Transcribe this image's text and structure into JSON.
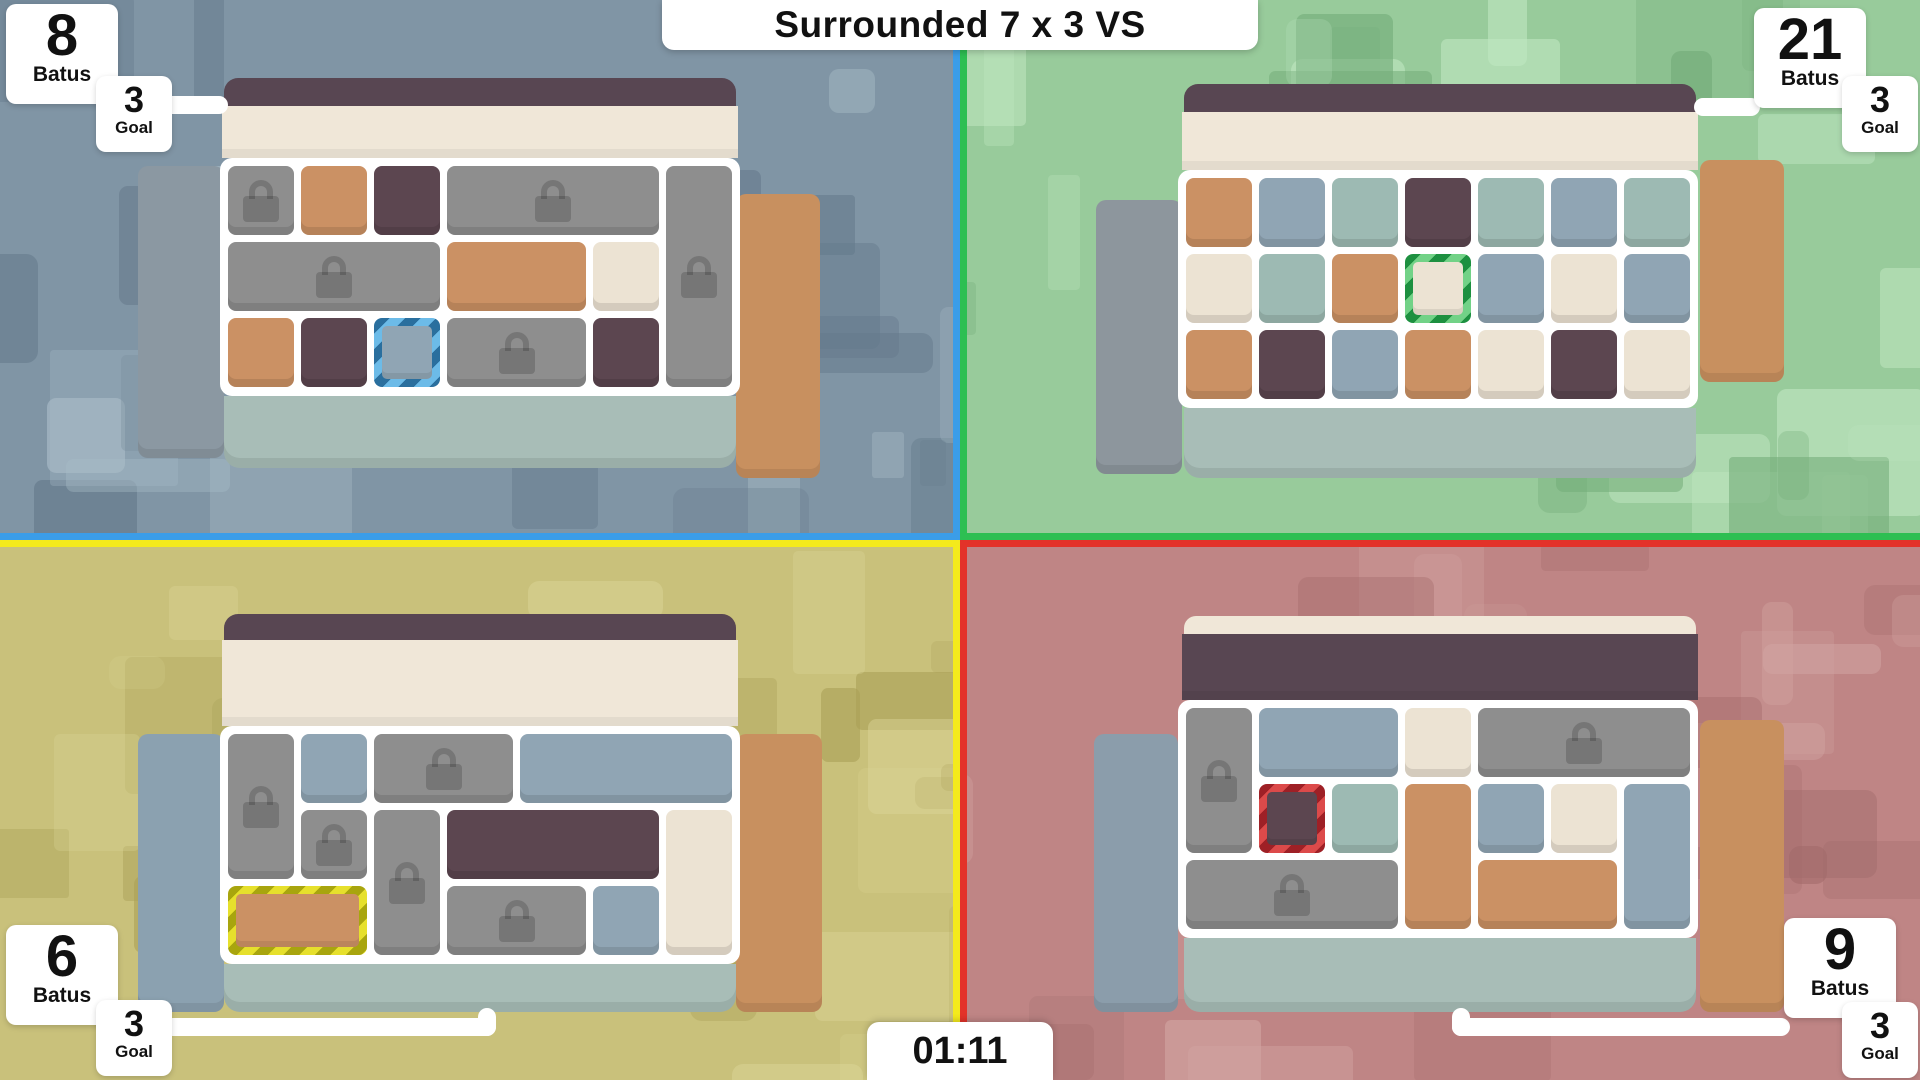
{
  "title": "Surrounded 7 x 3 VS",
  "timer": "01:11",
  "labels": {
    "score": "Batus",
    "goal": "Goal"
  },
  "palette": {
    "tiles": {
      "gray": "#8e8e8e",
      "orange": "#cb9164",
      "purple": "#5c4650",
      "cream": "#ece3d3",
      "slate": "#90a5b4",
      "teal": "#9dbab3"
    },
    "chrome": {
      "topbar": "#584652",
      "cream_band": "#f0e7d8",
      "sage_band": "#a8bdb7",
      "frame": "#ffffff"
    }
  },
  "quadrants": {
    "tl": {
      "player": "blue",
      "score": "8",
      "goal": "3",
      "accent": "#3b9de8",
      "selection_stripes": [
        "#2a6f9e",
        "#6cbbe8"
      ],
      "bg": {
        "base": "#8095a5",
        "light": "#a9bcc7",
        "dark": "#64798b"
      },
      "trays": {
        "left": "#8b98a2",
        "right": "#c8905f"
      },
      "board": {
        "header": "normal",
        "cells": [
          {
            "c": 1,
            "r": 1,
            "t": "gray",
            "lock": true
          },
          {
            "c": 2,
            "r": 1,
            "t": "orange"
          },
          {
            "c": 3,
            "r": 1,
            "t": "purple"
          },
          {
            "c": 4,
            "r": 1,
            "w": 3,
            "t": "gray",
            "lock": true
          },
          {
            "c": 7,
            "r": 1,
            "h": 3,
            "t": "gray",
            "lock": true
          },
          {
            "c": 1,
            "r": 2,
            "w": 3,
            "t": "gray",
            "lock": true
          },
          {
            "c": 4,
            "r": 2,
            "w": 2,
            "t": "orange"
          },
          {
            "c": 6,
            "r": 2,
            "t": "cream"
          },
          {
            "c": 1,
            "r": 3,
            "t": "orange"
          },
          {
            "c": 2,
            "r": 3,
            "t": "purple"
          },
          {
            "c": 3,
            "r": 3,
            "t": "slate",
            "sel": true
          },
          {
            "c": 4,
            "r": 3,
            "w": 2,
            "t": "gray",
            "lock": true
          },
          {
            "c": 6,
            "r": 3,
            "t": "purple"
          }
        ]
      }
    },
    "tr": {
      "player": "green",
      "score": "21",
      "goal": "3",
      "accent": "#2dbf52",
      "selection_stripes": [
        "#1d9040",
        "#72d287"
      ],
      "bg": {
        "base": "#98cb9b",
        "light": "#c0e7c1",
        "dark": "#74ad7a"
      },
      "trays": {
        "left": "#8d969d",
        "right": "#c8905f"
      },
      "board": {
        "header": "normal",
        "cells": [
          {
            "c": 1,
            "r": 1,
            "t": "orange"
          },
          {
            "c": 2,
            "r": 1,
            "t": "slate"
          },
          {
            "c": 3,
            "r": 1,
            "t": "teal"
          },
          {
            "c": 4,
            "r": 1,
            "t": "purple"
          },
          {
            "c": 5,
            "r": 1,
            "t": "teal"
          },
          {
            "c": 6,
            "r": 1,
            "t": "slate"
          },
          {
            "c": 7,
            "r": 1,
            "t": "teal"
          },
          {
            "c": 1,
            "r": 2,
            "t": "cream"
          },
          {
            "c": 2,
            "r": 2,
            "t": "teal"
          },
          {
            "c": 3,
            "r": 2,
            "t": "orange"
          },
          {
            "c": 4,
            "r": 2,
            "t": "cream",
            "sel": true
          },
          {
            "c": 5,
            "r": 2,
            "t": "slate"
          },
          {
            "c": 6,
            "r": 2,
            "t": "cream"
          },
          {
            "c": 7,
            "r": 2,
            "t": "slate"
          },
          {
            "c": 1,
            "r": 3,
            "t": "orange"
          },
          {
            "c": 2,
            "r": 3,
            "t": "purple"
          },
          {
            "c": 3,
            "r": 3,
            "t": "slate"
          },
          {
            "c": 4,
            "r": 3,
            "t": "orange"
          },
          {
            "c": 5,
            "r": 3,
            "t": "cream"
          },
          {
            "c": 6,
            "r": 3,
            "t": "purple"
          },
          {
            "c": 7,
            "r": 3,
            "t": "cream"
          }
        ]
      }
    },
    "bl": {
      "player": "yellow",
      "score": "6",
      "goal": "3",
      "accent": "#f4ea1c",
      "selection_stripes": [
        "#a8a50e",
        "#e6e02c"
      ],
      "bg": {
        "base": "#c9c17b",
        "light": "#dcd698",
        "dark": "#aaa057"
      },
      "trays": {
        "left": "#8ba1b0",
        "right": "#c8905f"
      },
      "board": {
        "header": "normal",
        "cells": [
          {
            "c": 1,
            "r": 1,
            "h": 2,
            "t": "gray",
            "lock": true
          },
          {
            "c": 2,
            "r": 1,
            "t": "slate"
          },
          {
            "c": 3,
            "r": 1,
            "w": 2,
            "t": "gray",
            "lock": true
          },
          {
            "c": 5,
            "r": 1,
            "w": 3,
            "t": "slate"
          },
          {
            "c": 2,
            "r": 2,
            "t": "gray",
            "lock": true
          },
          {
            "c": 3,
            "r": 2,
            "h": 2,
            "t": "gray",
            "lock": true
          },
          {
            "c": 4,
            "r": 2,
            "w": 3,
            "t": "purple"
          },
          {
            "c": 7,
            "r": 2,
            "h": 2,
            "t": "cream"
          },
          {
            "c": 1,
            "r": 3,
            "w": 2,
            "t": "orange",
            "sel": true
          },
          {
            "c": 4,
            "r": 3,
            "w": 2,
            "t": "gray",
            "lock": true
          },
          {
            "c": 6,
            "r": 3,
            "t": "slate"
          }
        ]
      }
    },
    "br": {
      "player": "red",
      "score": "9",
      "goal": "3",
      "accent": "#e33229",
      "selection_stripes": [
        "#9e2026",
        "#dc4a4a"
      ],
      "bg": {
        "base": "#bf8585",
        "light": "#d2a4a1",
        "dark": "#a16a6a"
      },
      "trays": {
        "left": "#8b9dab",
        "right": "#c8905f"
      },
      "board": {
        "header": "inverted",
        "cells": [
          {
            "c": 1,
            "r": 1,
            "h": 2,
            "t": "gray",
            "lock": true
          },
          {
            "c": 2,
            "r": 1,
            "w": 2,
            "t": "slate"
          },
          {
            "c": 4,
            "r": 1,
            "t": "cream"
          },
          {
            "c": 5,
            "r": 1,
            "w": 3,
            "t": "gray",
            "lock": true
          },
          {
            "c": 2,
            "r": 2,
            "t": "purple",
            "sel": true
          },
          {
            "c": 3,
            "r": 2,
            "t": "teal"
          },
          {
            "c": 4,
            "r": 2,
            "h": 2,
            "t": "orange"
          },
          {
            "c": 5,
            "r": 2,
            "t": "slate"
          },
          {
            "c": 6,
            "r": 2,
            "t": "cream"
          },
          {
            "c": 7,
            "r": 2,
            "h": 2,
            "t": "slate"
          },
          {
            "c": 1,
            "r": 3,
            "w": 3,
            "t": "gray",
            "lock": true
          },
          {
            "c": 5,
            "r": 3,
            "w": 2,
            "t": "orange"
          }
        ]
      }
    }
  }
}
